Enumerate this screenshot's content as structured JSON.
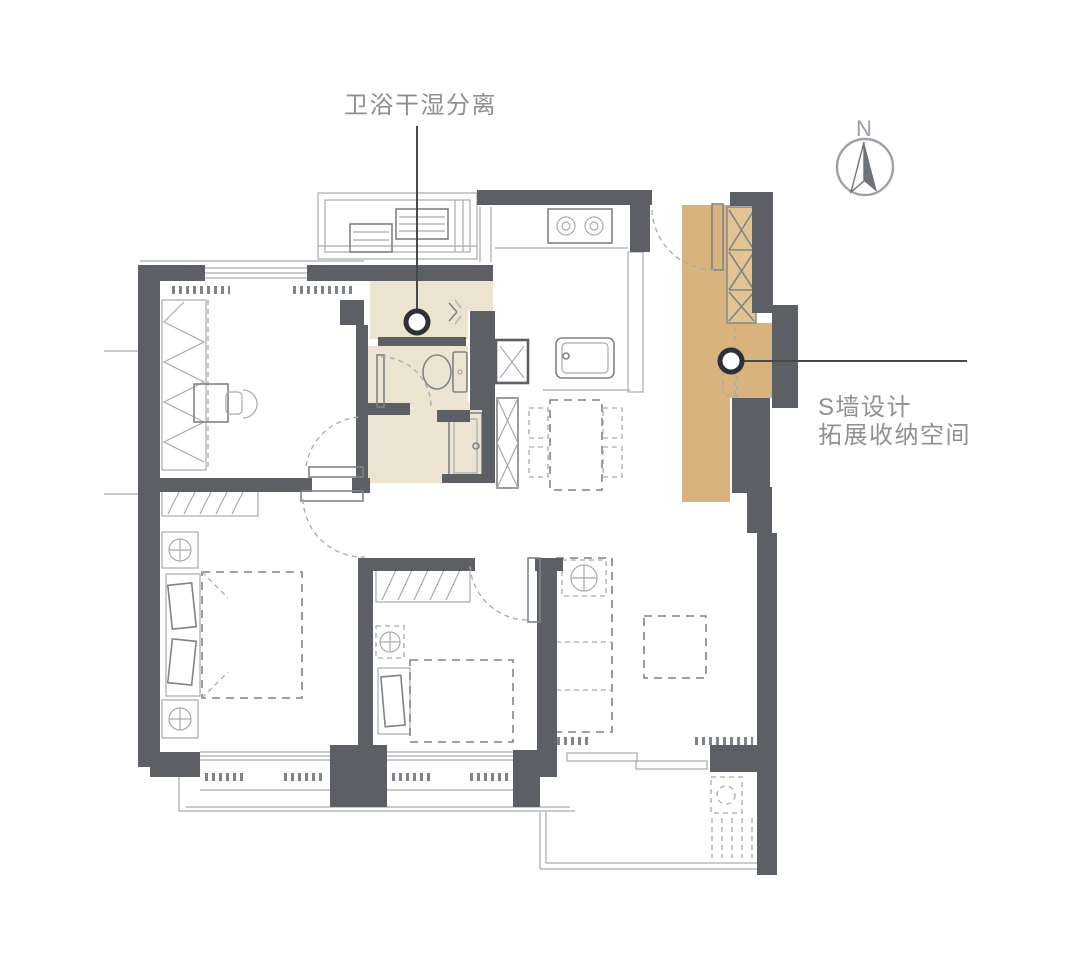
{
  "annotations": {
    "bathroom": {
      "label": "卫浴干湿分离",
      "icon": "callout-dot-marker"
    },
    "storage_wall": {
      "line1": "S墙设计",
      "line2": "拓展收纳空间",
      "icon": "callout-dot-marker"
    }
  },
  "compass": {
    "label": "N",
    "icon": "compass-north-icon"
  },
  "colors": {
    "bg": "#ffffff",
    "wall": "#5c6065",
    "line-light": "#a6abae",
    "line-mid": "#7f8487",
    "cream": "#ece4d0",
    "tan": "#d9b37d",
    "tan-light": "#e2c392",
    "leader": "#47494d",
    "marker": "#2e3236",
    "text": "#8e9093",
    "compass": "#9ba1a6",
    "compass-dark": "#6e7377"
  }
}
